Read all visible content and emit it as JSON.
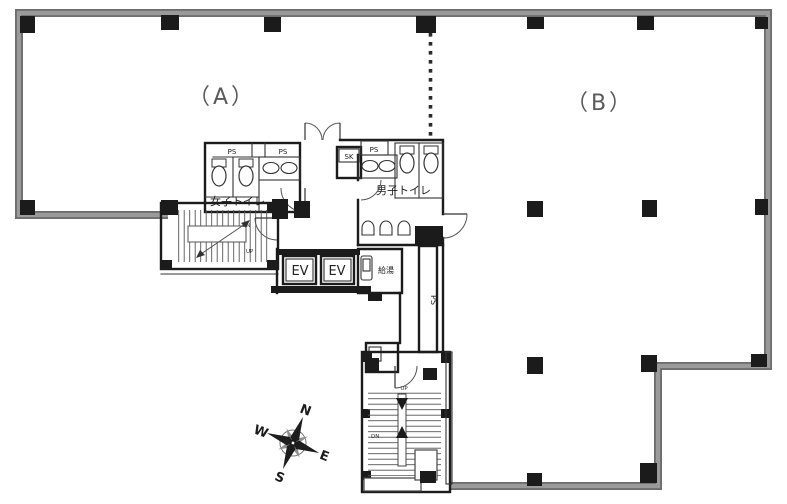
{
  "zone_a_label": "（A）",
  "zone_b_label": "（B）",
  "core": {
    "womens_toilet_label": "女子トイレ",
    "mens_toilet_label": "男子トイレ",
    "sk_label": "SK",
    "ps_label": "PS",
    "ev_label": "EV",
    "hot_water_label": "給湯"
  },
  "stairs_upper": {
    "dn_label": "DN",
    "up_label": "UP"
  },
  "stairs_lower": {
    "up_label": "UP",
    "dn_label": "DN"
  },
  "compass": {
    "north": "N",
    "east": "E",
    "south": "S",
    "west": "W"
  },
  "colors": {
    "outer_wall": "#9a9a9a",
    "outer_wall_dark": "#6e6e6e",
    "core_wall": "#1b1b1b",
    "label_gray": "#4f4f4f",
    "background": "#ffffff"
  }
}
